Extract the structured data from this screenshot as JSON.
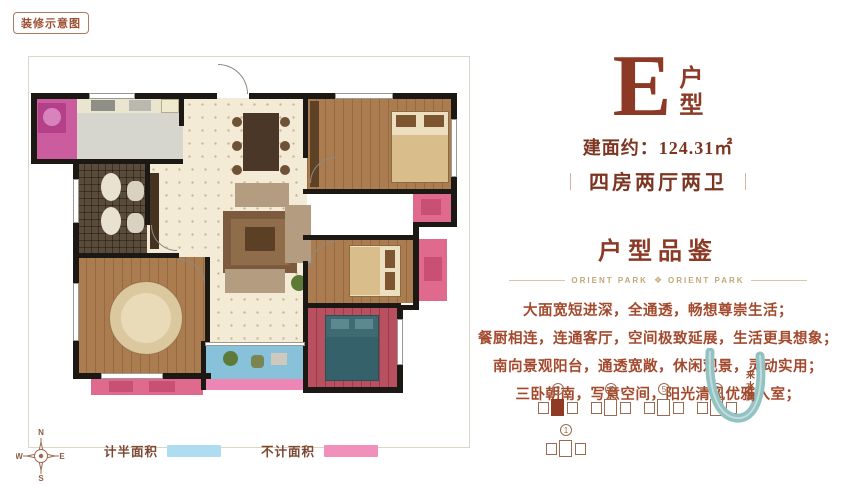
{
  "badge": {
    "label": "装修示意图"
  },
  "header": {
    "type_letter": "E",
    "type_word_top": "户",
    "type_word_bottom": "型",
    "area": "建面约：124.31㎡",
    "separator": "｜",
    "layout": "四房两厅两卫"
  },
  "section": {
    "title": "户型品鉴",
    "brand_left": "ORIENT PARK",
    "brand_right": "ORIENT PARK",
    "ornament": "❖",
    "lines": [
      "大面宽短进深，全通透，畅想尊崇生活；",
      "餐厨相连，连通客厅，空间极致延展，生活更具想象；",
      "南向景观阳台，通透宽敞，休闲观景，灵动实用；",
      "三卧朝南，写意空间，阳光清风优雅入室；"
    ]
  },
  "legend": {
    "items": [
      {
        "label": "计半面积",
        "color": "#aedcf0"
      },
      {
        "label": "不计面积",
        "color": "#f190bb"
      }
    ]
  },
  "compass": {
    "n": "N",
    "e": "E",
    "s": "S",
    "w": "W"
  },
  "site": {
    "river_label": "来水湾",
    "buildings": [
      {
        "num": "2",
        "highlight": true,
        "row": 1
      },
      {
        "num": "3",
        "highlight": false,
        "row": 1
      },
      {
        "num": "5",
        "highlight": false,
        "row": 1
      },
      {
        "num": "6",
        "highlight": false,
        "row": 1
      },
      {
        "num": "1",
        "highlight": false,
        "row": 2
      }
    ]
  },
  "colors": {
    "brand_brown": "#8c3a25",
    "text_brown": "#a34a2e",
    "divider_tan": "#c2a878",
    "half_area_blue": "#aedcf0",
    "excluded_pink": "#f190bb",
    "river_teal": "#92c2c2"
  },
  "floorplan": {
    "shapes": [
      {
        "n": "room-laundry",
        "x": 5,
        "y": 41,
        "w": 43,
        "h": 65,
        "c": "#cb5c9e"
      },
      {
        "n": "room-kitchen",
        "x": 48,
        "y": 41,
        "w": 106,
        "h": 65,
        "c": "#d6d6cf"
      },
      {
        "n": "kitchen-counter",
        "x": 48,
        "y": 41,
        "w": 106,
        "h": 15,
        "c": "#eae5cf"
      },
      {
        "n": "room-entry-dining",
        "k": "tile",
        "x": 154,
        "y": 41,
        "w": 124,
        "h": 110,
        "c": "#f3ebd6"
      },
      {
        "n": "room-bedroom-north",
        "k": "wood",
        "x": 278,
        "y": 41,
        "w": 146,
        "h": 95,
        "c": "#ab7c4f"
      },
      {
        "n": "platform-north",
        "x": 384,
        "y": 136,
        "w": 38,
        "h": 30,
        "c": "#e06a8e"
      },
      {
        "n": "room-bath",
        "k": "mosaic",
        "x": 48,
        "y": 106,
        "w": 70,
        "h": 92,
        "c": "#5a4b3b"
      },
      {
        "n": "room-living",
        "k": "tile",
        "x": 118,
        "y": 106,
        "w": 160,
        "h": 180,
        "c": "#f3ebd6"
      },
      {
        "n": "room-bedroom-middle",
        "k": "wood",
        "x": 278,
        "y": 180,
        "w": 108,
        "h": 66,
        "c": "#ab7c4f"
      },
      {
        "n": "platform-middle",
        "x": 390,
        "y": 182,
        "w": 28,
        "h": 62,
        "c": "#e06a8e"
      },
      {
        "n": "room-master",
        "k": "wood",
        "x": 48,
        "y": 200,
        "w": 132,
        "h": 116,
        "c": "#ab7c4f"
      },
      {
        "n": "platform-master",
        "x": 62,
        "y": 320,
        "w": 112,
        "h": 18,
        "c": "#e06a8e"
      },
      {
        "n": "room-balcony",
        "x": 176,
        "y": 286,
        "w": 100,
        "h": 36,
        "c": "#87c1da"
      },
      {
        "n": "balcony-edge",
        "x": 176,
        "y": 322,
        "w": 100,
        "h": 11,
        "c": "#ee86b5"
      },
      {
        "n": "room-bedroom-south",
        "k": "woodred",
        "x": 278,
        "y": 250,
        "w": 90,
        "h": 80,
        "c": "#b8505f"
      },
      {
        "n": "washing-machine",
        "x": 9,
        "y": 46,
        "w": 28,
        "h": 30,
        "c": "#b4408a"
      },
      {
        "n": "washer-drum",
        "x": 14,
        "y": 51,
        "w": 18,
        "h": 18,
        "c": "#d983bd",
        "r": 50
      },
      {
        "n": "stove",
        "x": 62,
        "y": 43,
        "w": 24,
        "h": 11,
        "c": "#8f8f88"
      },
      {
        "n": "kitchen-sink",
        "x": 100,
        "y": 43,
        "w": 22,
        "h": 11,
        "c": "#b9b9b1"
      },
      {
        "n": "fridge",
        "x": 132,
        "y": 42,
        "w": 18,
        "h": 14,
        "c": "#efe9cd",
        "b": "#b5ad8a"
      },
      {
        "n": "dining-table",
        "x": 214,
        "y": 56,
        "w": 36,
        "h": 58,
        "c": "#4a3727"
      },
      {
        "n": "dining-chair",
        "x": 203,
        "y": 60,
        "w": 10,
        "h": 10,
        "c": "#6f5138",
        "r": 50
      },
      {
        "n": "dining-chair",
        "x": 203,
        "y": 84,
        "w": 10,
        "h": 10,
        "c": "#6f5138",
        "r": 50
      },
      {
        "n": "dining-chair",
        "x": 203,
        "y": 108,
        "w": 10,
        "h": 10,
        "c": "#6f5138",
        "r": 50
      },
      {
        "n": "dining-chair",
        "x": 251,
        "y": 60,
        "w": 10,
        "h": 10,
        "c": "#6f5138",
        "r": 50
      },
      {
        "n": "dining-chair",
        "x": 251,
        "y": 84,
        "w": 10,
        "h": 10,
        "c": "#6f5138",
        "r": 50
      },
      {
        "n": "dining-chair",
        "x": 251,
        "y": 108,
        "w": 10,
        "h": 10,
        "c": "#6f5138",
        "r": 50
      },
      {
        "n": "rug",
        "x": 194,
        "y": 154,
        "w": 74,
        "h": 62,
        "c": "#7b5a3e"
      },
      {
        "n": "rug-inner",
        "x": 202,
        "y": 162,
        "w": 58,
        "h": 46,
        "c": "#8f6c4a"
      },
      {
        "n": "sofa-top",
        "x": 206,
        "y": 126,
        "w": 54,
        "h": 24,
        "c": "#b49c80"
      },
      {
        "n": "sofa-right",
        "x": 256,
        "y": 148,
        "w": 26,
        "h": 58,
        "c": "#b49c80"
      },
      {
        "n": "sofa-bottom",
        "x": 196,
        "y": 212,
        "w": 60,
        "h": 24,
        "c": "#b49c80"
      },
      {
        "n": "coffee-table",
        "x": 216,
        "y": 170,
        "w": 30,
        "h": 24,
        "c": "#5c4026"
      },
      {
        "n": "tv-cabinet",
        "x": 121,
        "y": 116,
        "w": 9,
        "h": 76,
        "c": "#45321f"
      },
      {
        "n": "wardrobe",
        "x": 281,
        "y": 44,
        "w": 9,
        "h": 86,
        "c": "#5e4226"
      },
      {
        "n": "bed-north",
        "x": 362,
        "y": 54,
        "w": 58,
        "h": 72,
        "c": "#ecdfc0",
        "b": "#8a6a43"
      },
      {
        "n": "bed-north-blanket",
        "x": 363,
        "y": 78,
        "w": 56,
        "h": 47,
        "c": "#d9bd8a"
      },
      {
        "n": "bed-north-pillow",
        "x": 367,
        "y": 58,
        "w": 20,
        "h": 12,
        "c": "#7d5530"
      },
      {
        "n": "bed-north-pillow",
        "x": 395,
        "y": 58,
        "w": 20,
        "h": 12,
        "c": "#7d5530"
      },
      {
        "n": "bed-middle",
        "x": 320,
        "y": 188,
        "w": 52,
        "h": 52,
        "c": "#ecdfc0",
        "b": "#8a6a43"
      },
      {
        "n": "bed-middle-blanket",
        "x": 321,
        "y": 190,
        "w": 30,
        "h": 48,
        "c": "#d9bd8a"
      },
      {
        "n": "bed-middle-pillow",
        "x": 356,
        "y": 193,
        "w": 10,
        "h": 18,
        "c": "#7d5530"
      },
      {
        "n": "bed-middle-pillow",
        "x": 356,
        "y": 215,
        "w": 10,
        "h": 18,
        "c": "#7d5530"
      },
      {
        "n": "bed-south",
        "x": 296,
        "y": 258,
        "w": 54,
        "h": 66,
        "c": "#3e6a72",
        "b": "#2c4f56"
      },
      {
        "n": "bed-south-blanket",
        "x": 297,
        "y": 280,
        "w": 52,
        "h": 43,
        "c": "#35616b"
      },
      {
        "n": "bed-south-pillow",
        "x": 302,
        "y": 262,
        "w": 18,
        "h": 10,
        "c": "#5d8891"
      },
      {
        "n": "bed-south-pillow",
        "x": 326,
        "y": 262,
        "w": 18,
        "h": 10,
        "c": "#5d8891"
      },
      {
        "n": "round-bed",
        "x": 80,
        "y": 224,
        "w": 74,
        "h": 74,
        "c": "#dcc89f",
        "b": "#97764e",
        "r": 50
      },
      {
        "n": "round-bed-inner",
        "x": 92,
        "y": 236,
        "w": 50,
        "h": 50,
        "c": "#e9dab8",
        "r": 50
      },
      {
        "n": "bath-sink",
        "x": 72,
        "y": 116,
        "w": 20,
        "h": 28,
        "c": "#e9e1d1",
        "r": 50
      },
      {
        "n": "bath-sink",
        "x": 72,
        "y": 150,
        "w": 20,
        "h": 28,
        "c": "#e9e1d1",
        "r": 50
      },
      {
        "n": "toilet",
        "x": 98,
        "y": 124,
        "w": 17,
        "h": 20,
        "c": "#d9d1c1",
        "r": 40
      },
      {
        "n": "toilet",
        "x": 98,
        "y": 156,
        "w": 17,
        "h": 20,
        "c": "#d9d1c1",
        "r": 40
      },
      {
        "n": "balcony-plant",
        "x": 194,
        "y": 294,
        "w": 15,
        "h": 15,
        "c": "#5d7a36",
        "r": 50
      },
      {
        "n": "balcony-chair",
        "x": 222,
        "y": 298,
        "w": 13,
        "h": 13,
        "c": "#7b8551",
        "r": 30
      },
      {
        "n": "balcony-mat",
        "x": 242,
        "y": 296,
        "w": 16,
        "h": 12,
        "c": "#cfc9bd"
      },
      {
        "n": "plant",
        "x": 262,
        "y": 218,
        "w": 16,
        "h": 16,
        "c": "#5d7a36",
        "r": 50
      },
      {
        "n": "platform-north-item",
        "x": 392,
        "y": 142,
        "w": 20,
        "h": 16,
        "c": "#c94f74"
      },
      {
        "n": "platform-middle-item",
        "x": 395,
        "y": 200,
        "w": 18,
        "h": 24,
        "c": "#c94f74"
      },
      {
        "n": "platform-master-item",
        "x": 80,
        "y": 324,
        "w": 24,
        "h": 11,
        "c": "#c94f74"
      },
      {
        "n": "platform-master-item",
        "x": 120,
        "y": 324,
        "w": 26,
        "h": 11,
        "c": "#c94f74"
      },
      {
        "n": "wall",
        "k": "wall",
        "x": 2,
        "y": 36,
        "w": 186,
        "h": 6
      },
      {
        "n": "wall",
        "k": "wall",
        "x": 220,
        "y": 36,
        "w": 208,
        "h": 6
      },
      {
        "n": "wall",
        "k": "wall",
        "x": 2,
        "y": 36,
        "w": 6,
        "h": 71
      },
      {
        "n": "wall",
        "k": "wall",
        "x": 2,
        "y": 102,
        "w": 152,
        "h": 5
      },
      {
        "n": "wall",
        "k": "wall",
        "x": 44,
        "y": 102,
        "w": 6,
        "h": 219
      },
      {
        "n": "wall",
        "k": "wall",
        "x": 44,
        "y": 316,
        "w": 138,
        "h": 6
      },
      {
        "n": "wall",
        "k": "wall",
        "x": 422,
        "y": 36,
        "w": 6,
        "h": 134
      },
      {
        "n": "wall",
        "k": "wall",
        "x": 384,
        "y": 165,
        "w": 44,
        "h": 5
      },
      {
        "n": "wall",
        "k": "wall",
        "x": 384,
        "y": 165,
        "w": 6,
        "h": 88
      },
      {
        "n": "wall",
        "k": "wall",
        "x": 368,
        "y": 248,
        "w": 22,
        "h": 5
      },
      {
        "n": "wall",
        "k": "wall",
        "x": 368,
        "y": 248,
        "w": 6,
        "h": 88
      },
      {
        "n": "wall",
        "k": "wall",
        "x": 274,
        "y": 330,
        "w": 100,
        "h": 6
      },
      {
        "n": "wall",
        "k": "wall",
        "x": 150,
        "y": 41,
        "w": 5,
        "h": 28
      },
      {
        "n": "wall",
        "k": "wall",
        "x": 116,
        "y": 106,
        "w": 5,
        "h": 62
      },
      {
        "n": "wall",
        "k": "wall",
        "x": 44,
        "y": 196,
        "w": 106,
        "h": 5
      },
      {
        "n": "wall",
        "k": "wall",
        "x": 176,
        "y": 200,
        "w": 5,
        "h": 86
      },
      {
        "n": "wall",
        "k": "wall",
        "x": 274,
        "y": 41,
        "w": 5,
        "h": 60
      },
      {
        "n": "wall",
        "k": "wall",
        "x": 274,
        "y": 132,
        "w": 152,
        "h": 5
      },
      {
        "n": "wall",
        "k": "wall",
        "x": 274,
        "y": 178,
        "w": 114,
        "h": 5
      },
      {
        "n": "wall",
        "k": "wall",
        "x": 274,
        "y": 204,
        "w": 5,
        "h": 44
      },
      {
        "n": "wall",
        "k": "wall",
        "x": 274,
        "y": 246,
        "w": 98,
        "h": 5
      },
      {
        "n": "wall",
        "k": "wall",
        "x": 274,
        "y": 246,
        "w": 5,
        "h": 90
      },
      {
        "n": "wall",
        "k": "wall",
        "x": 172,
        "y": 284,
        "w": 5,
        "h": 49
      },
      {
        "n": "window",
        "k": "win",
        "x": 60,
        "y": 36,
        "w": 46,
        "h": 6
      },
      {
        "n": "window",
        "k": "win",
        "x": 306,
        "y": 36,
        "w": 58,
        "h": 6
      },
      {
        "n": "window",
        "k": "win",
        "x": 44,
        "y": 122,
        "w": 6,
        "h": 44
      },
      {
        "n": "window",
        "k": "win",
        "x": 44,
        "y": 226,
        "w": 6,
        "h": 58
      },
      {
        "n": "window",
        "k": "win",
        "x": 72,
        "y": 316,
        "w": 62,
        "h": 6
      },
      {
        "n": "window",
        "k": "win",
        "x": 422,
        "y": 62,
        "w": 6,
        "h": 58
      },
      {
        "n": "window",
        "k": "win",
        "x": 176,
        "y": 285,
        "w": 100,
        "h": 4
      },
      {
        "n": "window",
        "k": "win",
        "x": 368,
        "y": 262,
        "w": 6,
        "h": 46
      },
      {
        "n": "door-arc",
        "k": "arcTR",
        "x": 189,
        "y": 7,
        "w": 30,
        "h": 30
      },
      {
        "n": "door-arc",
        "k": "arcBL",
        "x": 122,
        "y": 168,
        "w": 26,
        "h": 26
      },
      {
        "n": "door-arc",
        "k": "arcTL",
        "x": 281,
        "y": 100,
        "w": 26,
        "h": 26
      },
      {
        "n": "door-arc",
        "k": "arcTR",
        "x": 150,
        "y": 202,
        "w": 26,
        "h": 26
      },
      {
        "n": "door-arc",
        "k": "arcTL",
        "x": 281,
        "y": 184,
        "w": 26,
        "h": 26
      }
    ]
  }
}
